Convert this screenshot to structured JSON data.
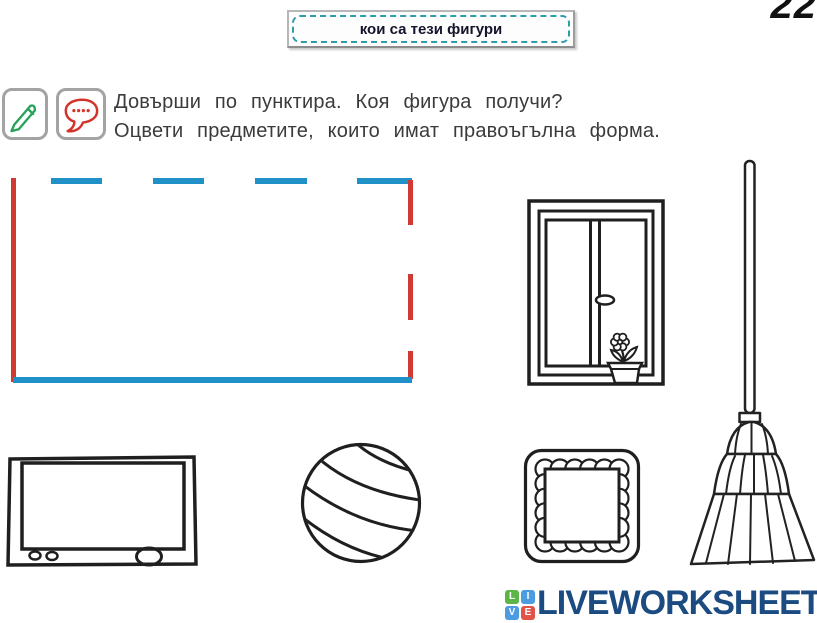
{
  "page": {
    "number": "22",
    "background_color": "#ffffff"
  },
  "title_box": {
    "text": "кои са тези фигури",
    "dashed_border_color": "#2d9dab"
  },
  "task": {
    "line1": "Довърши по пунктира. Коя фигура получи?",
    "line2": "Оцвети предметите, които имат правоъгълна форма.",
    "pencil_icon": "pencil-icon",
    "pencil_icon_color": "#27a35a",
    "bubble_icon": "speech-bubble-icon",
    "bubble_icon_color": "#d2342a"
  },
  "tracing": {
    "shape": "rectangle",
    "blue_color": "#2091c6",
    "red_color": "#d03a30",
    "solid_sides": [
      "left (red)",
      "bottom (blue)"
    ],
    "dashed_sides": [
      "top (blue dashes)",
      "right (red dashes)"
    ]
  },
  "objects": {
    "window": "window-illustration",
    "broom": "broom-illustration",
    "tv": "television-illustration",
    "ball": "ball-illustration",
    "frame": "scalloped-frame-illustration"
  },
  "footer": {
    "brand": "LIVEWORKSHEETS",
    "brand_color": "#1b4b80",
    "tiles": [
      {
        "letter": "L",
        "color": "#5cb547"
      },
      {
        "letter": "I",
        "color": "#4d9be0"
      },
      {
        "letter": "V",
        "color": "#4d9be0"
      },
      {
        "letter": "E",
        "color": "#e25449"
      }
    ]
  }
}
